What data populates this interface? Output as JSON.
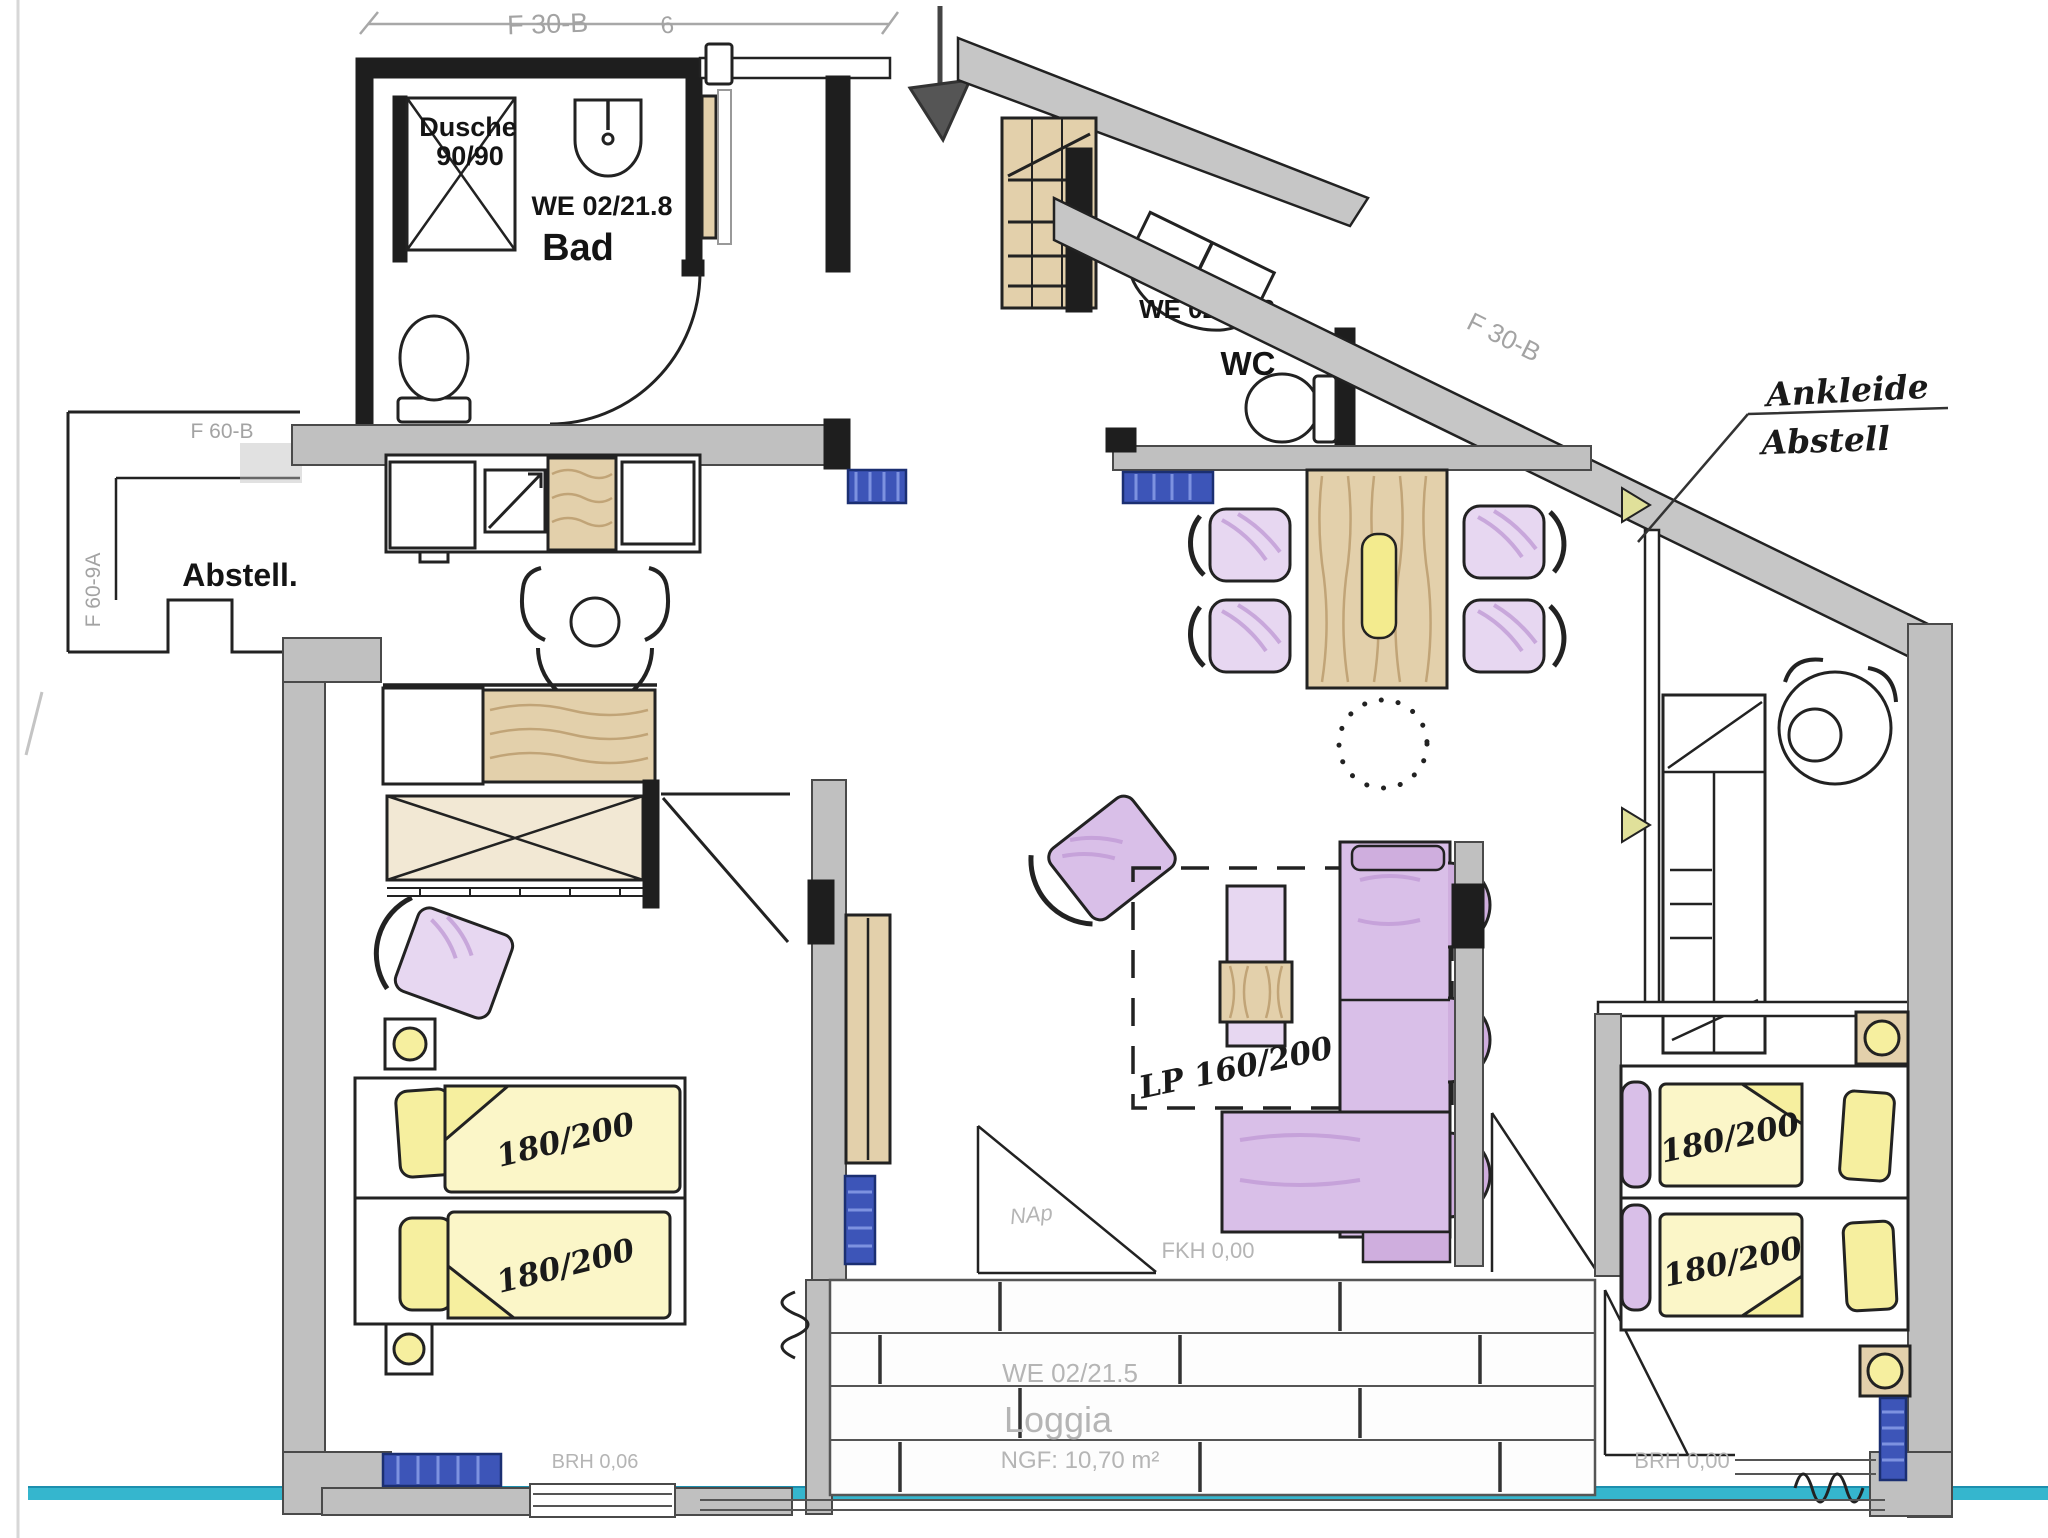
{
  "colors": {
    "wall_gray": "#c0c0c0",
    "wood_tan": "#e3d0ab",
    "accent_yellow": "#f6ef9f",
    "accent_purple": "#d9bfe8",
    "radiator_blue": "#3d55b8",
    "baseline_teal": "#35b6ce",
    "faint_print_gray": "#b5b5b5"
  },
  "labels": {
    "bathroom": {
      "unit": "WE 02/21.8",
      "room": "Bad",
      "shower_line1": "Dusche",
      "shower_line2": "90/90"
    },
    "wc": {
      "unit": "WE 02/21.2",
      "room": "WC"
    },
    "storage": {
      "room": "Abstell."
    },
    "dressing": {
      "note_line1": "Ankleide",
      "note_line2": "Abstell"
    },
    "loggia": {
      "unit": "WE 02/21.5",
      "room": "Loggia",
      "area": "NGF: 10,70 m²"
    },
    "beds": {
      "left_top": "180/200",
      "left_bottom": "180/200",
      "right_top": "180/200",
      "right_bottom": "180/200",
      "pullout": "LP 160/200"
    },
    "walls": {
      "top_dim": "F 30-B",
      "top_dim_mark": "6",
      "slope": "F 30-B",
      "storage_top": "F 60-B",
      "storage_side": "F 60-9A"
    },
    "heights": {
      "fkh": "FKH 0,00",
      "brh_left": "BRH 0,06",
      "brh_right": "BRH 0,00",
      "note": "NAp"
    }
  }
}
